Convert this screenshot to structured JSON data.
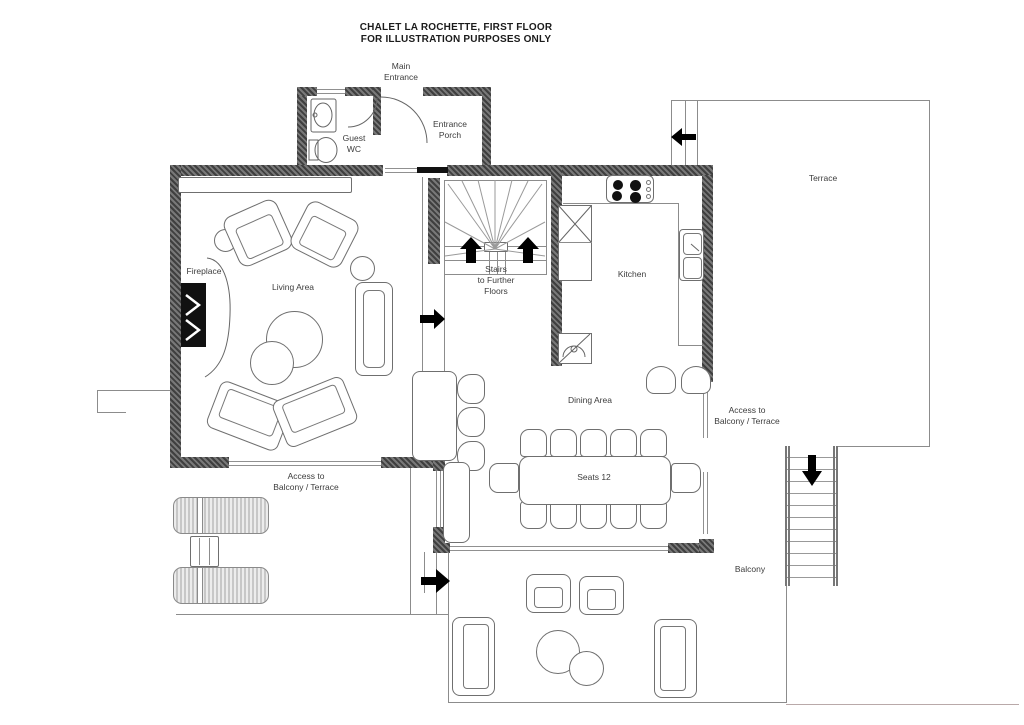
{
  "title": {
    "line1": "CHALET LA ROCHETTE, FIRST FLOOR",
    "line2": "FOR ILLUSTRATION PURPOSES ONLY"
  },
  "labels": {
    "main_entrance": "Main\nEntrance",
    "guest_wc": "Guest\nWC",
    "entrance_porch": "Entrance\nPorch",
    "terrace": "Terrace",
    "fireplace": "Fireplace",
    "living_area": "Living Area",
    "stairs": "Stairs\nto Further\nFloors",
    "kitchen": "Kitchen",
    "dining_area": "Dining Area",
    "access_balcony_right": "Access to\nBalcony / Terrace",
    "seats": "Seats 12",
    "access_balcony_left": "Access to\nBalcony / Terrace",
    "balcony": "Balcony"
  },
  "icons": {
    "stairs_up_arrows": "up-arrow",
    "hall_arrow": "right-arrow",
    "terrace_passage_arrow": "left-arrow",
    "balcony_stairs_arrow": "down-arrow",
    "balcony_door_arrow": "right-arrow"
  },
  "colors": {
    "wall": "#4a4a4a",
    "line": "#8c8c8c",
    "arrow": "#000000",
    "text": "#3c3c3c",
    "background": "#ffffff"
  }
}
